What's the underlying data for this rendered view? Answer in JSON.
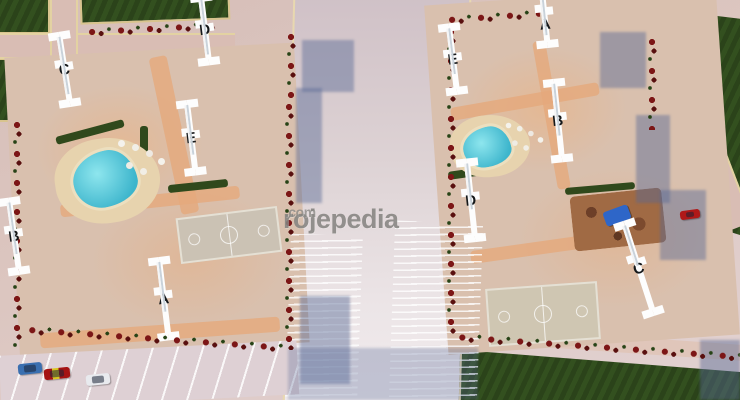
{
  "scene": {
    "description": "Bird's-eye 3D architectural rendering of a two-block residential apartment project with lettered buildings, pools, sport courts and parking",
    "view": "aerial-render"
  },
  "watermark": {
    "text": "rojepedia",
    "suffix": ".com"
  },
  "left_complex": {
    "buildings": [
      {
        "label": "C"
      },
      {
        "label": "D"
      },
      {
        "label": "E"
      },
      {
        "label": "B"
      },
      {
        "label": "A"
      }
    ],
    "amenities": [
      "swimming-pool",
      "pool-deck-umbrellas",
      "basketball-court",
      "parking-lot"
    ],
    "cars": [
      "blue",
      "red-taxi",
      "white"
    ]
  },
  "right_complex": {
    "buildings": [
      {
        "label": "A"
      },
      {
        "label": "E"
      },
      {
        "label": "B"
      },
      {
        "label": "D"
      },
      {
        "label": "C"
      }
    ],
    "amenities": [
      "swimming-pool",
      "playground",
      "basketball-court"
    ],
    "cars": [
      "red"
    ]
  },
  "colors": {
    "roof_gray": "#8d979a",
    "roof_outline_white": "#fdfdfd",
    "pool_turquoise": "#3db5cc",
    "grass_green": "#2b431a",
    "road_pink": "#d9bdb4",
    "curb_tan": "#e3d2a2",
    "walkway_salmon": "#e5a97c",
    "tree_red": "#7c1616",
    "shadow_blue": "rgba(86,104,148,0.45)"
  }
}
